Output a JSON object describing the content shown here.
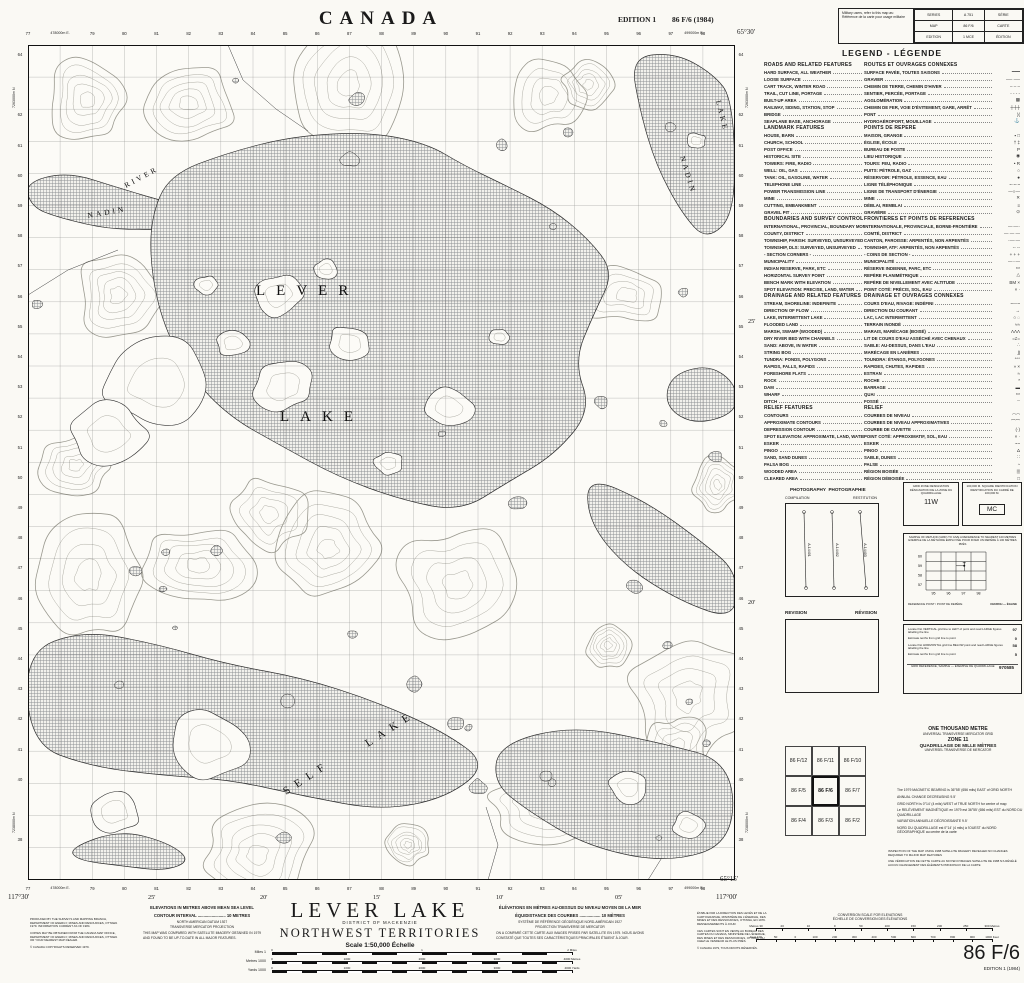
{
  "header": {
    "country": "CANADA",
    "edition": "EDITION 1",
    "sheet": "86 F/6 (1984)"
  },
  "military_box": {
    "note_en": "Military users, refer to this map as:",
    "note_fr": "Référence de la carte pour usage militaire",
    "rows": [
      [
        "SERIES",
        "A 751",
        "SÉRIE"
      ],
      [
        "MAP",
        "86 F/6",
        "CARTE"
      ],
      [
        "EDITION",
        "1 MCE",
        "ÉDITION"
      ]
    ]
  },
  "legend": {
    "title": "LEGEND - LÉGENDE",
    "sections": [
      {
        "en": "ROADS AND RELATED FEATURES",
        "fr": "ROUTES ET OUVRAGES CONNEXES",
        "items": [
          {
            "en": "HARD SURFACE, ALL WEATHER",
            "fr": "SURFACE PAVÉE, TOUTES SAISONS",
            "sym": "━━━"
          },
          {
            "en": "LOOSE SURFACE",
            "fr": "GRAVIER",
            "sym": "── ──"
          },
          {
            "en": "CART TRACK, WINTER ROAD",
            "fr": "CHEMIN DE TERRE, CHEMIN D'HIVER",
            "sym": "– – –"
          },
          {
            "en": "TRAIL, CUT LINE, PORTAGE",
            "fr": "SENTIER, PERCÉE, PORTAGE",
            "sym": "- - - -"
          },
          {
            "en": "BUILT-UP AREA",
            "fr": "AGGLOMÉRATION",
            "sym": "▩"
          },
          {
            "en": "RAILWAY, SIDING, STATION, STOP",
            "fr": "CHEMIN DE FER, VOIE D'ÉVITEMENT, GARE, ARRÊT",
            "sym": "┼┼┼"
          },
          {
            "en": "BRIDGE",
            "fr": "PONT",
            "sym": ")("
          },
          {
            "en": "SEAPLANE BASE, ANCHORAGE",
            "fr": "HYDROAÉROPORT, MOUILLAGE",
            "sym": "⚓"
          }
        ]
      },
      {
        "en": "LANDMARK FEATURES",
        "fr": "POINTS DE REPÈRE",
        "items": [
          {
            "en": "HOUSE, BARN",
            "fr": "MAISON, GRANGE",
            "sym": "▪ □"
          },
          {
            "en": "CHURCH, SCHOOL",
            "fr": "ÉGLISE, ÉCOLE",
            "sym": "† ‡"
          },
          {
            "en": "POST OFFICE",
            "fr": "BUREAU DE POSTE",
            "sym": "P"
          },
          {
            "en": "HISTORICAL SITE",
            "fr": "LIEU HISTORIQUE",
            "sym": "◉"
          },
          {
            "en": "TOWERS: FIRE, RADIO",
            "fr": "TOURS: FEU, RADIO",
            "sym": "• R"
          },
          {
            "en": "WELL: OIL, GAS",
            "fr": "PUITS: PÉTROLE, GAZ",
            "sym": "○"
          },
          {
            "en": "TANK: OIL, GASOLINE, WATER",
            "fr": "RÉSERVOIR: PÉTROLE, ESSENCE, EAU",
            "sym": "●"
          },
          {
            "en": "TELEPHONE LINE",
            "fr": "LIGNE TÉLÉPHONIQUE",
            "sym": "~·~·~"
          },
          {
            "en": "POWER TRANSMISSION LINE",
            "fr": "LIGNE DE TRANSPORT D'ÉNERGIE",
            "sym": "—○—"
          },
          {
            "en": "MINE",
            "fr": "MINE",
            "sym": "✕"
          },
          {
            "en": "CUTTING, EMBANKMENT",
            "fr": "DÉBLAI, REMBLAI",
            "sym": "≡"
          },
          {
            "en": "GRAVEL PIT",
            "fr": "GRAVIÈRE",
            "sym": "⊙"
          }
        ]
      },
      {
        "en": "BOUNDARIES AND SURVEY CONTROL",
        "fr": "FRONTIÈRES ET POINTS DE RÉFÉRENCES",
        "items": [
          {
            "en": "INTERNATIONAL, PROVINCIAL, BOUNDARY MONUMENT",
            "fr": "INTERNATIONALE, PROVINCIALE, BORNE-FRONTIÈRE",
            "sym": "—·—·"
          },
          {
            "en": "COUNTY, DISTRICT",
            "fr": "COMTÉ, DISTRICT",
            "sym": "— — —"
          },
          {
            "en": "TOWNSHIP, PARISH: SURVEYED, UNSURVEYED",
            "fr": "CANTON, PAROISSE: ARPENTÉS, NON ARPENTÉS",
            "sym": "·—·—"
          },
          {
            "en": "TOWNSHIP, DLS: SURVEYED, UNSURVEYED",
            "fr": "TOWNSHIP, ATF: ARPENTÉS, NON ARPENTÉS",
            "sym": "-- --"
          },
          {
            "en": "- SECTION CORNERS -",
            "fr": "- COINS DE SECTION -",
            "sym": "+ + +"
          },
          {
            "en": "MUNICIPALITY",
            "fr": "MUNICIPALITÉ",
            "sym": "—··—"
          },
          {
            "en": "INDIAN RESERVE, PARK, ETC",
            "fr": "RÉSERVE INDIENNE, PARC, ETC",
            "sym": "▭"
          },
          {
            "en": "HORIZONTAL SURVEY POINT",
            "fr": "REPÈRE PLANIMÉTRIQUE",
            "sym": "△"
          },
          {
            "en": "BENCH MARK WITH ELEVATION",
            "fr": "REPÈRE DE NIVELLEMENT AVEC ALTITUDE",
            "sym": "BM ×"
          },
          {
            "en": "SPOT ELEVATION: PRECISE, LAND, WATER",
            "fr": "POINT COTÉ: PRÉCIS, SOL, EAU",
            "sym": "× ·"
          }
        ]
      },
      {
        "en": "DRAINAGE AND RELATED FEATURES",
        "fr": "DRAINAGE ET OUVRAGES CONNEXES",
        "items": [
          {
            "en": "STREAM, SHORELINE: INDEFINITE",
            "fr": "COURS D'EAU, RIVAGE: INDÉFINI",
            "sym": "~—~"
          },
          {
            "en": "DIRECTION OF FLOW",
            "fr": "DIRECTION DU COURANT",
            "sym": "→"
          },
          {
            "en": "LAKE, INTERMITTENT LAKE",
            "fr": "LAC, LAC INTERMITTENT",
            "sym": "○ ◌"
          },
          {
            "en": "FLOODED LAND",
            "fr": "TERRAIN INONDÉ",
            "sym": "≈≈"
          },
          {
            "en": "MARSH, SWAMP (WOODED)",
            "fr": "MARAIS, MARÉCAGE (BOISÉ)",
            "sym": "ΛΛΛ"
          },
          {
            "en": "DRY RIVER BED WITH CHANNELS",
            "fr": "LIT DE COURS D'EAU ASSÉCHÉ AVEC CHENAUX",
            "sym": "=≠="
          },
          {
            "en": "SAND: ABOVE, IN WATER",
            "fr": "SABLE: AU-DESSUS, DANS L'EAU",
            "sym": "∴"
          },
          {
            "en": "STRING BOG",
            "fr": "MARÉCAGE EN LANIÈRES",
            "sym": "∫∫"
          },
          {
            "en": "TUNDRA: PONDS, POLYGONS",
            "fr": "TOUNDRA: ÉTANGS, POLYGONES",
            "sym": "°°°"
          },
          {
            "en": "RAPIDS, FALLS, RAPIDS",
            "fr": "RAPIDES, CHUTES, RAPIDES",
            "sym": "» ×"
          },
          {
            "en": "FORESHORE FLATS",
            "fr": "ESTRAN",
            "sym": "≈"
          },
          {
            "en": "ROCK",
            "fr": "ROCHE",
            "sym": "*"
          },
          {
            "en": "DAM",
            "fr": "BARRAGE",
            "sym": "▬"
          },
          {
            "en": "WHARF",
            "fr": "QUAI",
            "sym": "▭"
          },
          {
            "en": "DITCH",
            "fr": "FOSSÉ",
            "sym": "┄"
          }
        ]
      },
      {
        "en": "RELIEF FEATURES",
        "fr": "RELIEF",
        "items": [
          {
            "en": "CONTOURS",
            "fr": "COURBES DE NIVEAU",
            "sym": "◠◠"
          },
          {
            "en": "APPROXIMATE CONTOURS",
            "fr": "COURBES DE NIVEAU APPROXIMATIVES",
            "sym": "⌒⌒"
          },
          {
            "en": "DEPRESSION CONTOUR",
            "fr": "COURBE DE CUVETTE",
            "sym": "(·)"
          },
          {
            "en": "SPOT ELEVATION: APPROXIMATE, LAND, WATER",
            "fr": "POINT COTÉ: APPROXIMATIF, SOL, EAU",
            "sym": "× ·"
          },
          {
            "en": "ESKER",
            "fr": "ESKER",
            "sym": "~~"
          },
          {
            "en": "PINGO",
            "fr": "PINGO",
            "sym": "Δ"
          },
          {
            "en": "SAND, SAND DUNES",
            "fr": "SABLE, DUNES",
            "sym": "∷"
          },
          {
            "en": "PALSA BOG",
            "fr": "PALSE",
            "sym": "◔"
          },
          {
            "en": "WOODED AREA",
            "fr": "RÉGION BOISÉE",
            "sym": "▒"
          },
          {
            "en": "CLEARED AREA",
            "fr": "RÉGION DÉBOISÉE",
            "sym": "□"
          }
        ]
      }
    ]
  },
  "panels": {
    "photography": {
      "title_en": "PHOTOGRAPHY",
      "title_fr": "PHOTOGRAPHIE",
      "left": "COMPILATION",
      "right": "RESTITUTION",
      "lines": [
        "A-14401",
        "A-14402",
        "A-14403"
      ]
    },
    "revision": {
      "en": "REVISION",
      "fr": "RÉVISION"
    },
    "grid_zone": {
      "l1": "GRID ZONE DESIGNATION",
      "l2": "DÉSIGNATION DE LA ZONE DU QUADRILLAGE",
      "value": "11W"
    },
    "square_id": {
      "l1": "100,000 M. SQUARE IDENTIFICATION",
      "l2": "IDENTIFICATION DU CARRÉ DE 100,000 M.",
      "value": "MC"
    },
    "example": {
      "t1": "SAMPLE OF METHOD (GRID) TO GIVE A REFERENCE TO NEAREST 100 METRES",
      "t2": "EXEMPLE DE LA MÉTHODE EMPLOYÉE POUR FIXER UN REPÈRE À 100 MÈTRES PRÈS",
      "x_ticks": [
        "95",
        "96",
        "97",
        "98"
      ],
      "y_ticks": [
        "60",
        "59",
        "58",
        "57"
      ],
      "ref_en": "REFERENCE POINT",
      "ref_fr": "POINT DE REPÈRE",
      "ref_value": "CHURCH — ÉGLISE"
    },
    "instructions": {
      "steps": [
        [
          "Locate first VERTICAL grid line to LEFT of point and read LARGE figures labelling the line",
          "97"
        ],
        [
          "Estimate tenths from grid line to point",
          "0"
        ],
        [
          "Locate first HORIZONTAL grid line BELOW point and read LARGE figures labelling the line",
          "58"
        ],
        [
          "Estimate tenths from grid line to point",
          "5"
        ]
      ],
      "sample_label": "GRID REFERENCE, SAMPLE — EXEMPLE DE QUADRILLAGE",
      "sample_value": "970585"
    },
    "utm_block": {
      "l1": "ONE THOUSAND METRE",
      "l2": "UNIVERSAL TRANSVERSE MERCATOR GRID",
      "l3": "ZONE 11",
      "l4": "QUADRILLAGE DE MILLE MÈTRES",
      "l5": "UNIVERSEL TRANSVERSE DE MERCATOR"
    },
    "declination": [
      "The 1979 MAGNETIC BEARING is 36°55' (656 mils) EAST of GRID NORTH",
      "ANNUAL CHANGE DECREASING 9.5'",
      "GRID NORTH is 0°14' (4 mils) WEST of TRUE NORTH for centre of map",
      "Le RELÈVEMENT MAGNÉTIQUE en 1979 est 36°55' (656 mils) EST du NORD DU QUADRILLAGE",
      "VARIATION ANNUELLE DÉCROISSANTE 9.5'",
      "NORD DU QUADRILLAGE est 0°14' (4 mils) à l'OUEST du NORD GÉOGRAPHIQUE au centre de la carte"
    ],
    "satellite_notes": [
      "INSPECTION OF THE MAP USING 1988 SATELLITE IMAGERY REVEALED NO CHANGES REQUIRED TO MAJOR MAP FEATURES",
      "UNE VÉRIFICATION DE CETTE CARTE AU MOYEN D'IMAGES SATELLITE DE 1988 N'A RÉVÉLÉ AUCUN CHANGEMENT DES ÉLÉMENTS PRINCIPAUX DE LA CARTE"
    ],
    "adjacent": {
      "rows": [
        [
          "86 F/12",
          "86 F/11",
          "86 F/10"
        ],
        [
          "86 F/5",
          "86 F/6",
          "86 F/7"
        ],
        [
          "86 F/4",
          "86 F/3",
          "86 F/2"
        ]
      ],
      "current": "86 F/6"
    }
  },
  "map": {
    "name_labels": [
      {
        "t": "LEVER",
        "x": 228,
        "y": 250,
        "r": 0,
        "s": 15,
        "sp": 11
      },
      {
        "t": "LAKE",
        "x": 252,
        "y": 376,
        "r": 0,
        "s": 15,
        "sp": 11
      },
      {
        "t": "RIVER",
        "x": 98,
        "y": 143,
        "r": -28,
        "s": 7.5,
        "sp": 3
      },
      {
        "t": "NADIN",
        "x": 60,
        "y": 173,
        "r": -10,
        "s": 7.5,
        "sp": 3
      },
      {
        "t": "LAKE",
        "x": 688,
        "y": 56,
        "r": 76,
        "s": 7.5,
        "sp": 3
      },
      {
        "t": "NADIN",
        "x": 652,
        "y": 112,
        "r": 73,
        "s": 7.5,
        "sp": 3
      },
      {
        "t": "SELF",
        "x": 258,
        "y": 750,
        "r": -33,
        "s": 11,
        "sp": 7
      },
      {
        "t": "LAKE",
        "x": 340,
        "y": 702,
        "r": -33,
        "s": 11,
        "sp": 7
      }
    ],
    "corners": {
      "tr": "65°30'",
      "br_lat": "65°15'",
      "br_lon": "117°00'",
      "bl": "117°30'"
    },
    "eastings": [
      "77",
      "478000m E.",
      "79",
      "80",
      "81",
      "82",
      "83",
      "84",
      "85",
      "86",
      "87",
      "88",
      "89",
      "90",
      "91",
      "92",
      "93",
      "94",
      "95",
      "96",
      "97",
      "98"
    ],
    "easting_full_right": "499000m E.",
    "northing_start": 64,
    "northing_full_top": "7263000m N",
    "northing_full_bottom": "7238000m N",
    "lat_ticks": [
      "25'",
      "20'"
    ],
    "lon_ticks": [
      "25'",
      "20'",
      "15'",
      "10'",
      "05'"
    ]
  },
  "footer": {
    "title": "LEVER LAKE",
    "subtitle": "DISTRICT OF MACKENZIE",
    "territory": "NORTHWEST TERRITORIES",
    "scale_label": "Scale 1:50,000 Échelle",
    "notes_en": [
      "ELEVATIONS IN METRES ABOVE MEAN SEA LEVEL",
      "CONTOUR INTERVAL ........................ 10 METRES",
      "NORTH AMERICAN DATUM 1927",
      "TRANSVERSE MERCATOR PROJECTION",
      "THIS MAP WAS COMPARED WITH SATELLITE IMAGERY OBTAINED IN 1979 AND FOUND TO BE UP-TO-DATE IN ALL MAJOR FEATURES."
    ],
    "notes_fr": [
      "ÉLÉVATIONS EN MÈTRES AU-DESSUS DU NIVEAU MOYEN DE LA MER",
      "ÉQUIDISTANCE DES COURBES .................. 10 MÈTRES",
      "SYSTÈME DE RÉFÉRENCE GÉODÉSIQUE NORD-AMÉRICAIN 1927",
      "PROJECTION TRANSVERSE DE MERCATOR",
      "ON A COMPARÉ CETTE CARTE AUX IMAGES PRISES PAR SATELLITE EN 1979. NOUS AVONS CONSTATÉ QUE TOUTES SES CARACTÉRISTIQUES PRINCIPALES ÉTAIENT À JOUR."
    ],
    "credits_en": [
      "PRODUCED BY THE SURVEYS AND MAPPING BRANCH, DEPARTMENT OF ENERGY, MINES AND RESOURCES, OTTAWA 1979. INFORMATION CURRENT AS OF 1984.",
      "COPIES MAY BE OBTAINED FROM THE CANADA MAP OFFICE, DEPARTMENT OF ENERGY, MINES AND RESOURCES, OTTAWA OR YOUR NEAREST MAP DEALER.",
      "© CANADA COPYRIGHTS RESERVED 1979."
    ],
    "credits_fr": [
      "ÉTABLIE PAR LA DIRECTION DES LEVÉS ET DE LA CARTOGRAPHIE, MINISTÈRE DE L'ÉNERGIE, DES MINES ET DES RESSOURCES, OTTAWA, EN 1979. RENSEIGNEMENTS À JOUR.",
      "CES CARTES SONT EN VENTE AU BUREAU DES CARTES DU CANADA, MINISTÈRE DE L'ÉNERGIE, DES MINES ET DES RESSOURCES, OTTAWA, OU CHEZ LE VENDEUR LE PLUS PRÈS.",
      "© CANADA 1979, TOUS DROITS RÉSERVÉS."
    ],
    "scalebars": [
      {
        "left": "Miles 1",
        "ticks": [
          "0",
          "1",
          "2 Miles"
        ]
      },
      {
        "left": "Metres 1000",
        "ticks": [
          "0",
          "1000",
          "2000",
          "3000",
          "4000 Metres"
        ]
      },
      {
        "left": "Yards 1000",
        "ticks": [
          "0",
          "1000",
          "2000",
          "3000",
          "4000 Yards"
        ]
      }
    ],
    "conversion": {
      "t1": "CONVERSION SCALE FOR ELEVATIONS",
      "t2": "ÉCHELLE DE CONVERSION DES ÉLÉVATIONS",
      "metres": [
        "Metres 30",
        "20",
        "10",
        "0",
        "50",
        "100",
        "150",
        "200",
        "250",
        "300 Metres"
      ],
      "feet": [
        "Feet 100",
        "50",
        "0",
        "100",
        "200",
        "300",
        "400",
        "500",
        "600",
        "700",
        "800",
        "900",
        "1000 Feet"
      ]
    },
    "sheet_big": "86 F/6",
    "edition_note": "EDITION 1 (1984)"
  }
}
